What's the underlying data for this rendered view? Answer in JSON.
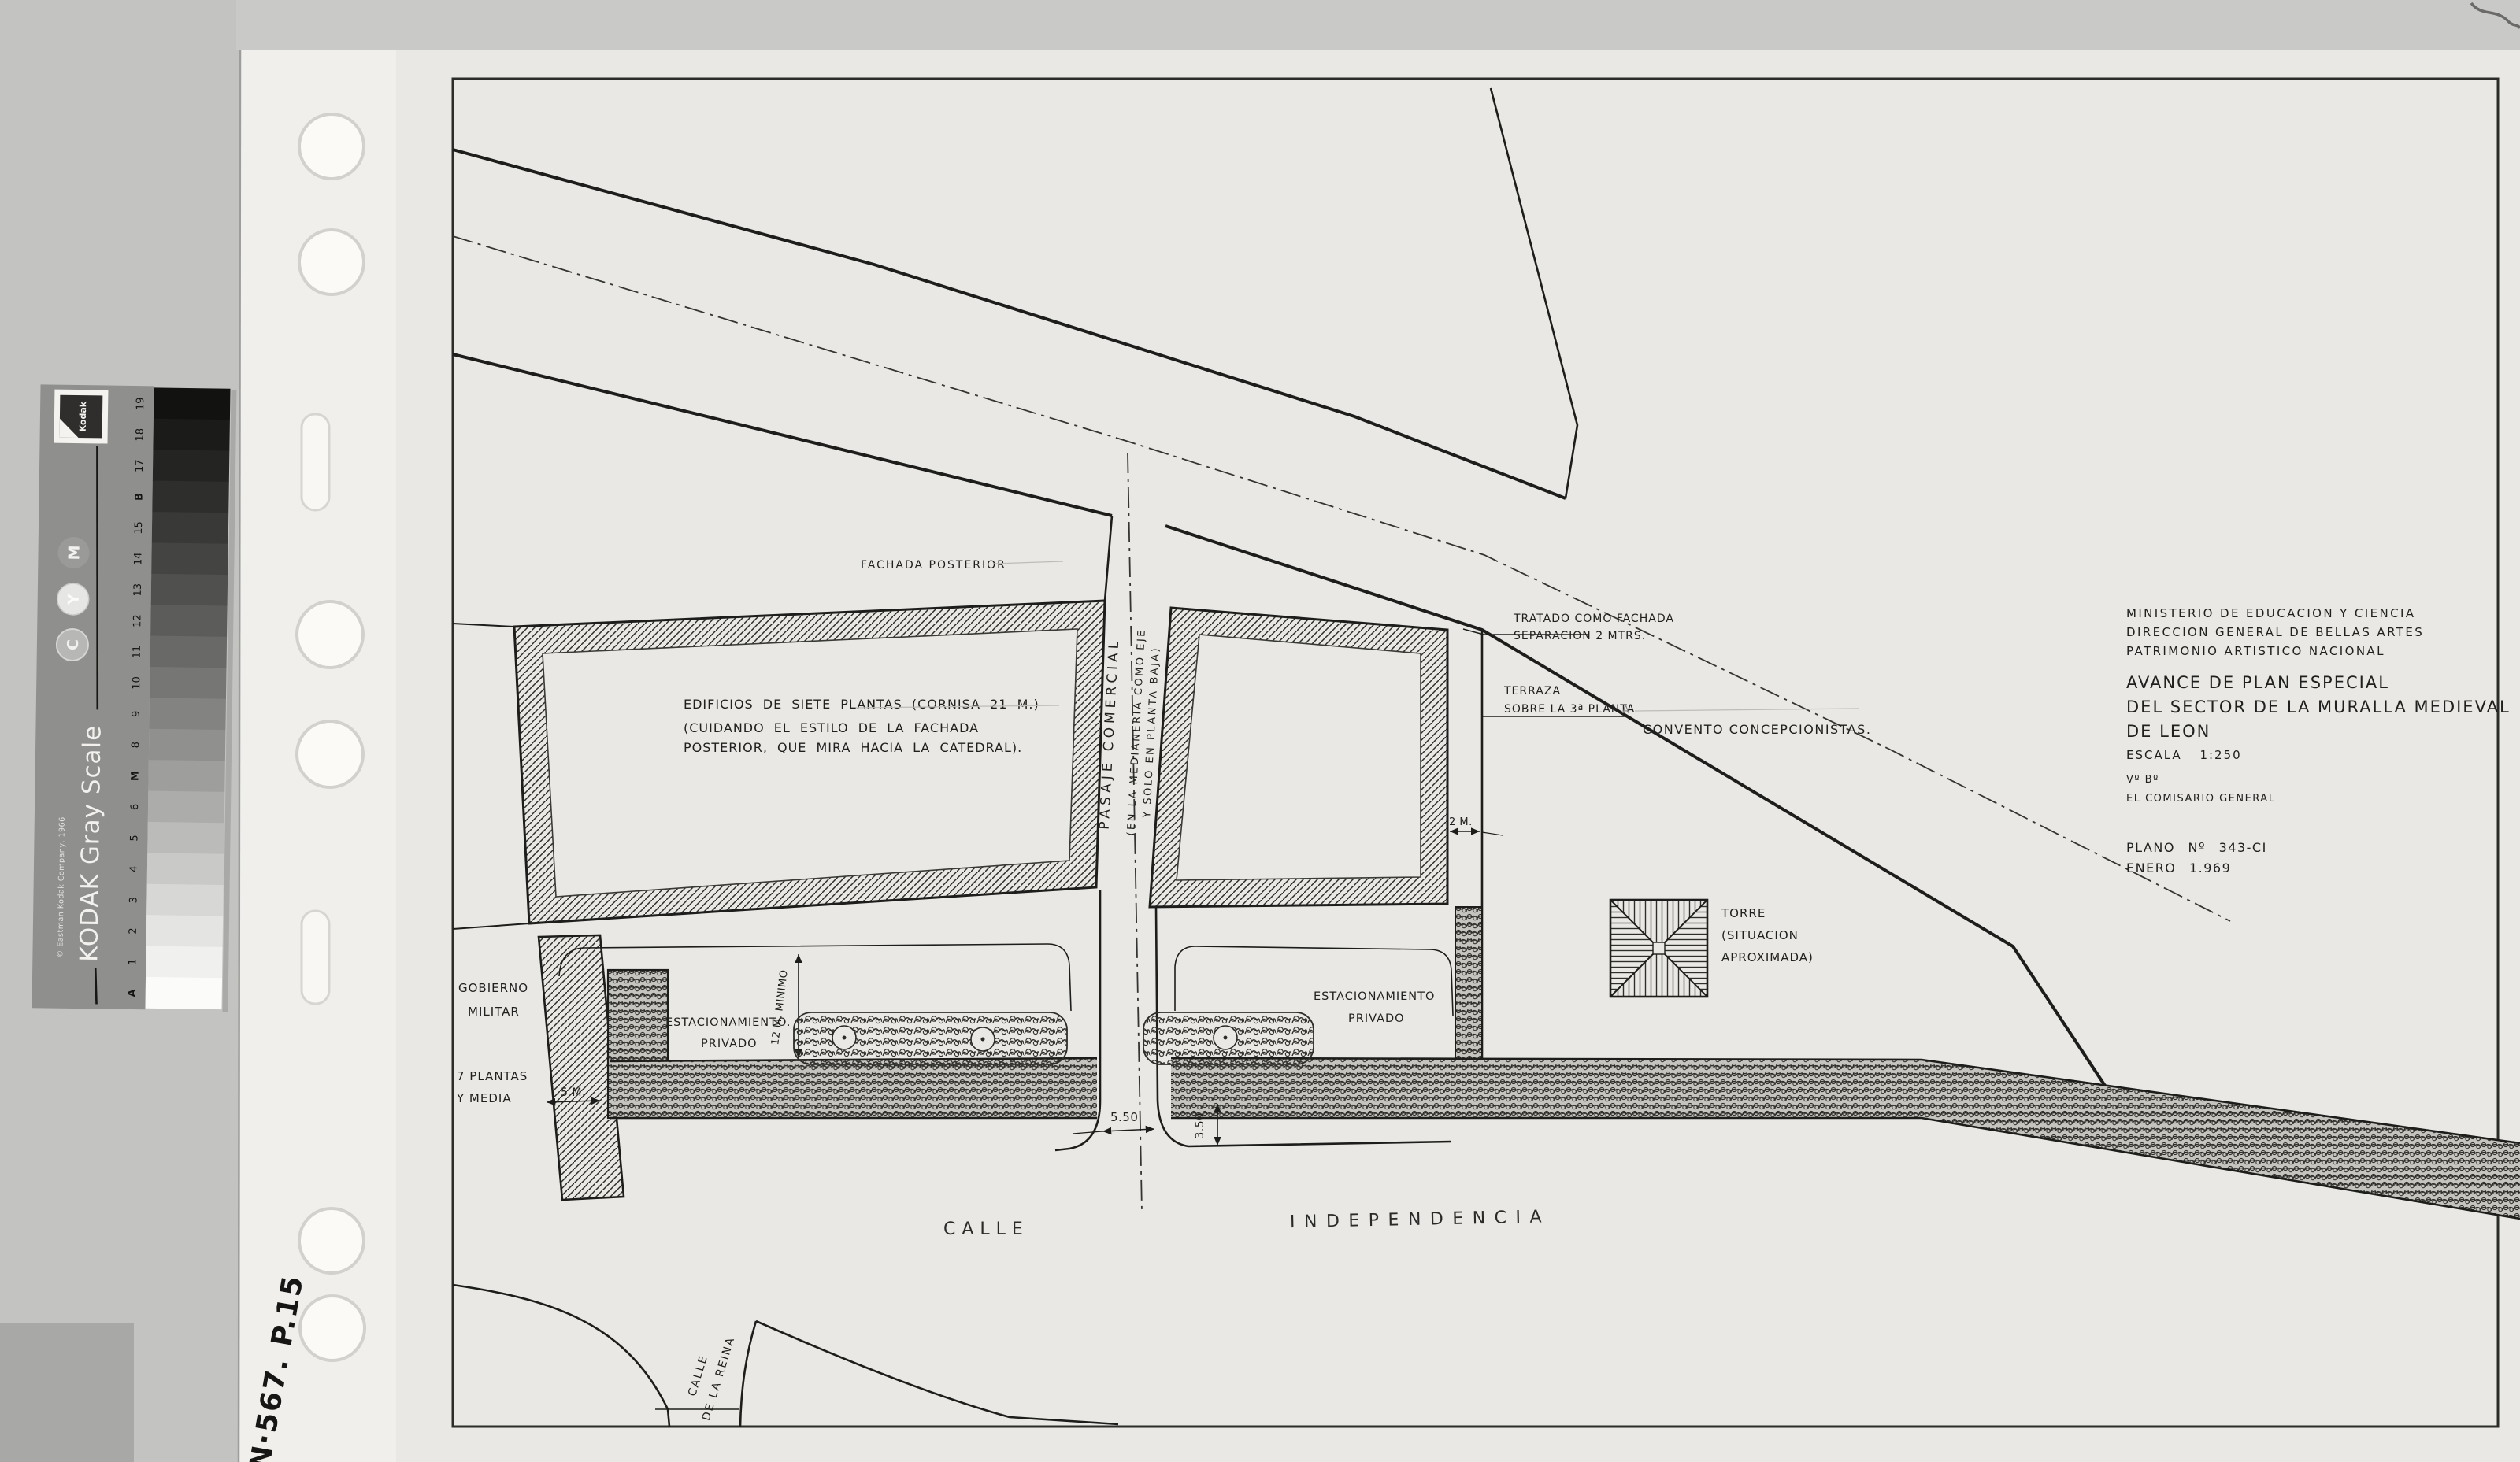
{
  "colors": {
    "background": "#c7c7c5",
    "paper": "#e9e8e5",
    "sleeve": "#f1f0ed",
    "ink": "#1d1d1b",
    "strip_label_gray": "#8f8f8d"
  },
  "gray_scale_strip": {
    "brand_title": "KODAK Gray Scale",
    "copyright": "© Eastman Kodak Company, 1966",
    "logo_text": "Kodak",
    "steps_top_to_bottom": [
      "19",
      "18",
      "17",
      "B",
      "15",
      "14",
      "13",
      "12",
      "11",
      "10",
      "9",
      "8",
      "M",
      "6",
      "5",
      "4",
      "3",
      "2",
      "1",
      "A"
    ],
    "shades_top_to_bottom": [
      "#121210",
      "#1b1b19",
      "#242422",
      "#2e2e2c",
      "#393937",
      "#444442",
      "#50504e",
      "#5c5c5a",
      "#696967",
      "#767674",
      "#838381",
      "#90908e",
      "#9e9e9c",
      "#acacaa",
      "#bbbbb9",
      "#c9c9c7",
      "#d7d7d5",
      "#e4e4e2",
      "#f0f0ee",
      "#fbfbf9"
    ],
    "color_patch_labels": [
      "M",
      "Y",
      "C"
    ],
    "color_patch_shades": [
      "#9a9a98",
      "#e6e6e4",
      "#b7b7b5"
    ]
  },
  "handwritten_note": "N·567. P.15",
  "plan": {
    "title_block": {
      "org_line1": "MINISTERIO DE EDUCACION Y CIENCIA",
      "org_line2": "DIRECCION GENERAL DE BELLAS ARTES",
      "org_line3": "PATRIMONIO ARTISTICO NACIONAL",
      "title_line1": "AVANCE DE PLAN ESPECIAL",
      "title_line2": "DEL SECTOR DE LA MURALLA MEDIEVAL",
      "title_line3": "DE LEON",
      "scale_label": "ESCALA 1:250",
      "approval": "Vº Bº",
      "approver": "EL COMISARIO GENERAL",
      "plan_number": "PLANO Nº 343-CI",
      "date": "ENERO 1.969"
    },
    "labels": {
      "fachada_posterior": "FACHADA POSTERIOR",
      "edificios_l1": "EDIFICIOS DE SIETE PLANTAS (CORNISA 21 M.)",
      "edificios_l2": "(CUIDANDO EL ESTILO DE LA FACHADA",
      "edificios_l3": "POSTERIOR, QUE MIRA HACIA LA CATEDRAL).",
      "pasaje": "PASAJE COMERCIAL",
      "pasaje_note_l1": "(EN LA MEDIANERIA COMO EJE",
      "pasaje_note_l2": "Y SOLO EN PLANTA BAJA)",
      "tratado_l1": "TRATADO COMO FACHADA",
      "tratado_l2": "SEPARACION 2 MTRS.",
      "terraza_l1": "TERRAZA",
      "terraza_l2": "SOBRE LA 3ª PLANTA",
      "convento": "CONVENTO CONCEPCIONISTAS.",
      "torre_l1": "TORRE",
      "torre_l2": "(SITUACION",
      "torre_l3": "APROXIMADA)",
      "gobierno_l1": "GOBIERNO",
      "gobierno_l2": "MILITAR",
      "plantas_l1": "7 PLANTAS",
      "plantas_l2": "Y MEDIA",
      "estacionamiento_left_l1": "ESTACIONAMIENTO.",
      "estacionamiento_left_l2": "PRIVADO",
      "estacionamiento_right_l1": "ESTACIONAMIENTO",
      "estacionamiento_right_l2": "PRIVADO",
      "section_mark": "A"
    },
    "dimensions": {
      "parking_depth": "12 M. MINIMO",
      "side_gap": "5 M.",
      "passage_width": "5.50",
      "wall_offset": "3.50",
      "separation": "2 M."
    },
    "streets": {
      "calle": "CALLE",
      "independencia": "INDEPENDENCIA",
      "reina_l1": "CALLE",
      "reina_l2": "DE LA REINA"
    }
  }
}
